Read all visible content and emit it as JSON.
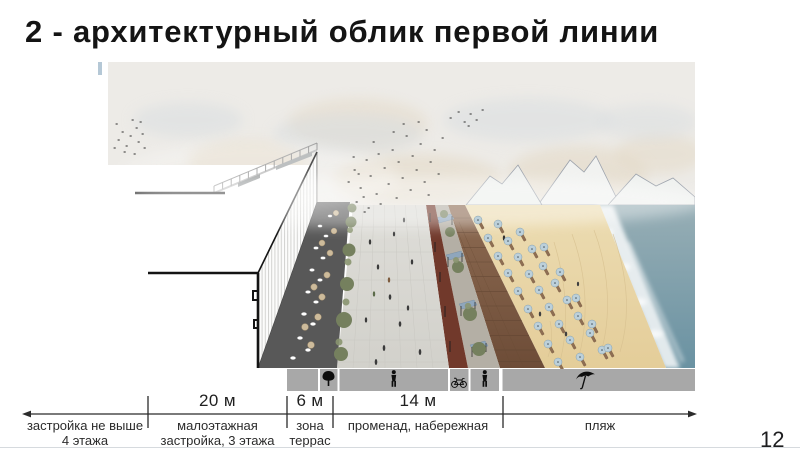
{
  "slide": {
    "title": "2 - архитектурный облик первой линии",
    "page_number": "12"
  },
  "dimension": {
    "segments": [
      {
        "measure": "",
        "lines": [
          "застройка не выше",
          "4 этажа"
        ]
      },
      {
        "measure": "20 м",
        "lines": [
          "малоэтажная",
          "застройка, 3 этажа"
        ]
      },
      {
        "measure": "6 м",
        "lines": [
          "зона",
          "террас"
        ]
      },
      {
        "measure": "14 м",
        "lines": [
          "променад, набережная",
          ""
        ]
      },
      {
        "measure": "",
        "lines": [
          "пляж",
          ""
        ]
      }
    ]
  },
  "icon_band": {
    "icons": [
      "none",
      "tree",
      "pedestrian",
      "bicycle",
      "pedestrian",
      "beach-umbrella"
    ]
  },
  "colors": {
    "sky": "#edebe7",
    "sea_top": "#97aeb5",
    "sea_bottom": "#6a92a2",
    "sand": "#e8d5a6",
    "boardwalk": "#7d5b43",
    "bike_lane": "#71392b",
    "promenade": "#d9d8d3",
    "furniture_strip": "#b4afa5",
    "terrace": "#585858",
    "umbrella": "#bcd0da",
    "icon_band_bg": "#a8a8a8",
    "dimension_text": "#2a2a2a"
  }
}
